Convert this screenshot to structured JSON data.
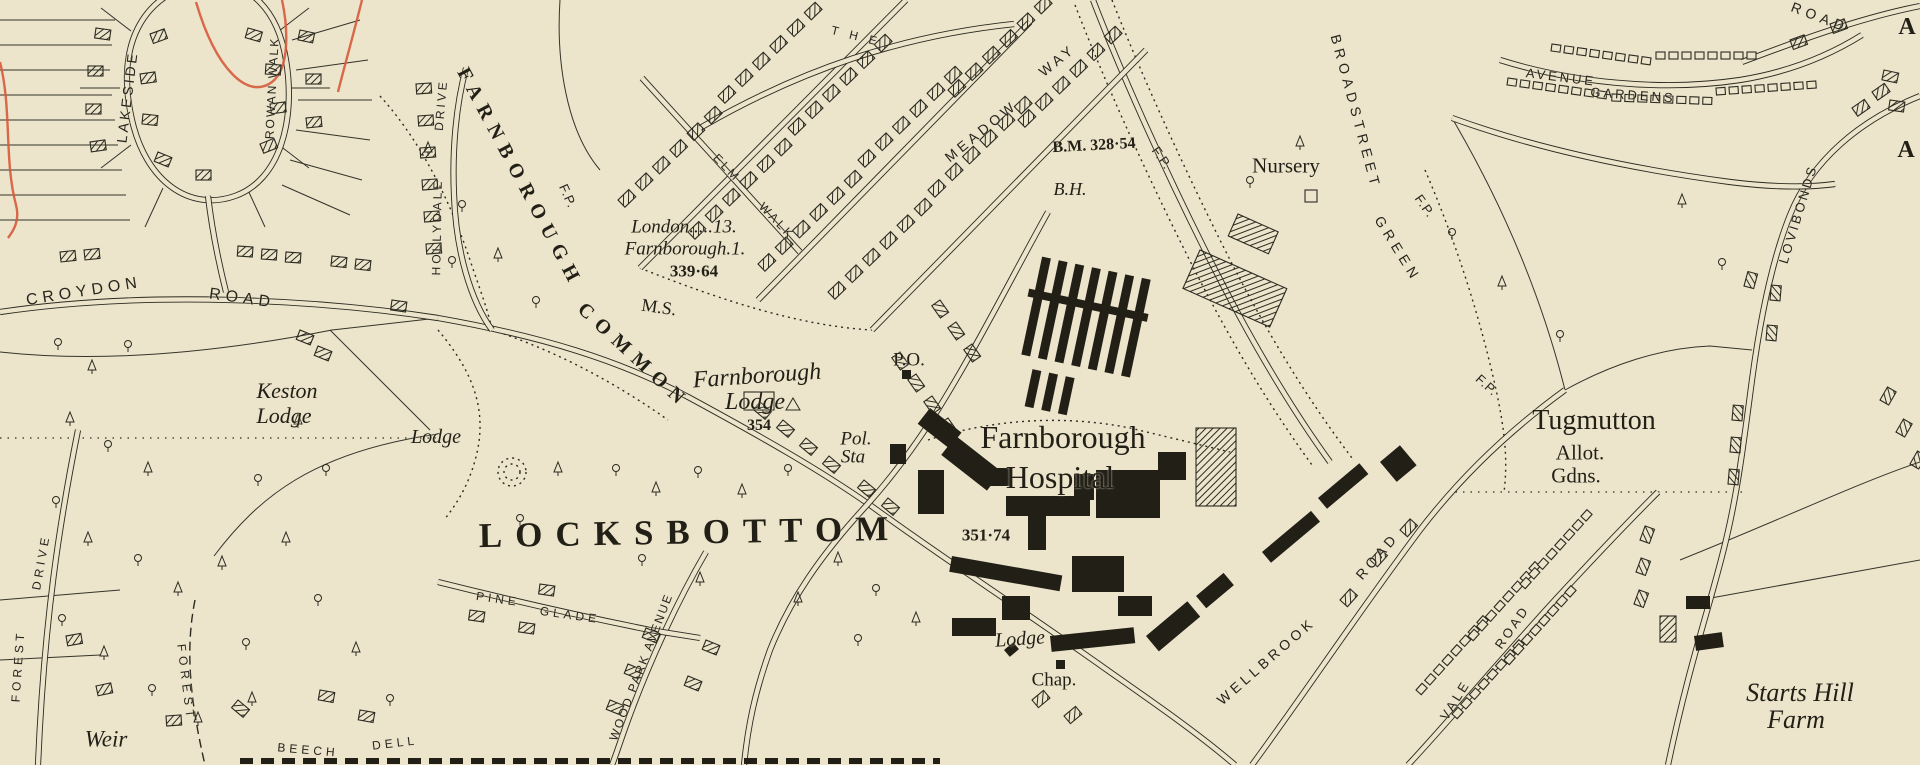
{
  "map": {
    "colors": {
      "paper": "#ece4cb",
      "ink": "#211f16",
      "boundary_red": "#d75a3c"
    },
    "labels": [
      {
        "t": "LAKESIDE",
        "x": 127,
        "y": 97,
        "r": -83,
        "s": 14,
        "ls": 3,
        "c": "street"
      },
      {
        "t": "ROWAN WALK",
        "x": 272,
        "y": 88,
        "r": -87,
        "s": 12,
        "ls": 2,
        "c": "street"
      },
      {
        "t": "CROYDON",
        "x": 84,
        "y": 292,
        "r": -9,
        "s": 16,
        "ls": 5,
        "c": "street"
      },
      {
        "t": "ROAD",
        "x": 242,
        "y": 299,
        "r": 8,
        "s": 16,
        "ls": 5,
        "c": "street"
      },
      {
        "t": "Keston",
        "x": 287,
        "y": 391,
        "r": 0,
        "s": 22,
        "c": "italic"
      },
      {
        "t": "Lodge",
        "x": 284,
        "y": 416,
        "r": 0,
        "s": 22,
        "c": "italic"
      },
      {
        "t": "Lodge",
        "x": 436,
        "y": 437,
        "r": 0,
        "s": 20,
        "c": "italic"
      },
      {
        "t": "DRIVE",
        "x": 441,
        "y": 105,
        "r": -85,
        "s": 12,
        "ls": 3,
        "c": "street"
      },
      {
        "t": "HOLLYDALE",
        "x": 437,
        "y": 227,
        "r": -89,
        "s": 12,
        "ls": 3,
        "c": "street"
      },
      {
        "t": "FARNBOROUGH",
        "x": 520,
        "y": 178,
        "r": 62,
        "s": 20,
        "ls": 8,
        "c": "caps"
      },
      {
        "t": "COMMON",
        "x": 634,
        "y": 356,
        "r": 43,
        "s": 20,
        "ls": 8,
        "c": "caps"
      },
      {
        "t": "F.P.",
        "x": 568,
        "y": 196,
        "r": 66,
        "s": 13,
        "ls": 1,
        "c": "street"
      },
      {
        "t": "London.....13.",
        "x": 684,
        "y": 227,
        "r": 0,
        "s": 19,
        "c": "italic"
      },
      {
        "t": "Farnborough.1.",
        "x": 685,
        "y": 249,
        "r": 0,
        "s": 19,
        "c": "italic"
      },
      {
        "t": "339·64",
        "x": 694,
        "y": 271,
        "r": 0,
        "s": 17,
        "c": "num"
      },
      {
        "t": "M.S.",
        "x": 659,
        "y": 307,
        "r": 8,
        "s": 18,
        "c": "serif"
      },
      {
        "t": "ELM",
        "x": 727,
        "y": 168,
        "r": 46,
        "s": 12,
        "ls": 3,
        "c": "street"
      },
      {
        "t": "WALK",
        "x": 777,
        "y": 221,
        "r": 46,
        "s": 12,
        "ls": 3,
        "c": "street"
      },
      {
        "t": "T H E",
        "x": 856,
        "y": 36,
        "r": 14,
        "s": 12,
        "ls": 4,
        "c": "street"
      },
      {
        "t": "MEADOW",
        "x": 981,
        "y": 131,
        "r": -39,
        "s": 14,
        "ls": 4,
        "c": "street"
      },
      {
        "t": "WAY",
        "x": 1057,
        "y": 60,
        "r": -39,
        "s": 14,
        "ls": 4,
        "c": "street"
      },
      {
        "t": "B.M. 328·54",
        "x": 1094,
        "y": 146,
        "r": -3,
        "s": 16,
        "c": "num"
      },
      {
        "t": "B.H.",
        "x": 1070,
        "y": 189,
        "r": 0,
        "s": 18,
        "c": "italic"
      },
      {
        "t": "Nursery",
        "x": 1286,
        "y": 166,
        "r": 0,
        "s": 21,
        "c": "serif"
      },
      {
        "t": "BROADSTREET",
        "x": 1356,
        "y": 112,
        "r": 75,
        "s": 14,
        "ls": 5,
        "c": "street"
      },
      {
        "t": "GREEN",
        "x": 1398,
        "y": 249,
        "r": 58,
        "s": 14,
        "ls": 5,
        "c": "street"
      },
      {
        "t": "F.P.",
        "x": 1162,
        "y": 158,
        "r": 55,
        "s": 13,
        "ls": 1,
        "c": "street"
      },
      {
        "t": "F.P.",
        "x": 1425,
        "y": 206,
        "r": 55,
        "s": 13,
        "ls": 1,
        "c": "street"
      },
      {
        "t": "AVENUE",
        "x": 1561,
        "y": 77,
        "r": 7,
        "s": 13,
        "ls": 3,
        "c": "street"
      },
      {
        "t": "GARDENS",
        "x": 1633,
        "y": 95,
        "r": 4,
        "s": 13,
        "ls": 3,
        "c": "street"
      },
      {
        "t": "ROAD",
        "x": 1820,
        "y": 17,
        "r": 21,
        "s": 14,
        "ls": 5,
        "c": "street"
      },
      {
        "t": "LOVIBONDS",
        "x": 1798,
        "y": 214,
        "r": -73,
        "s": 13,
        "ls": 3,
        "c": "street"
      },
      {
        "t": "A",
        "x": 1907,
        "y": 27,
        "r": 0,
        "s": 24,
        "c": "caps"
      },
      {
        "t": "A",
        "x": 1906,
        "y": 150,
        "r": 0,
        "s": 24,
        "c": "caps"
      },
      {
        "t": "Tugmutton",
        "x": 1594,
        "y": 421,
        "r": 0,
        "s": 28,
        "c": "serif"
      },
      {
        "t": "Allot.",
        "x": 1580,
        "y": 453,
        "r": 0,
        "s": 21,
        "c": "serif"
      },
      {
        "t": "Gdns.",
        "x": 1576,
        "y": 476,
        "r": 0,
        "s": 21,
        "c": "serif"
      },
      {
        "t": "F.P.",
        "x": 1487,
        "y": 385,
        "r": 42,
        "s": 13,
        "ls": 1,
        "c": "street"
      },
      {
        "t": "Starts Hill",
        "x": 1800,
        "y": 693,
        "r": 0,
        "s": 26,
        "c": "italic"
      },
      {
        "t": "Farm",
        "x": 1796,
        "y": 720,
        "r": 0,
        "s": 26,
        "c": "italic"
      },
      {
        "t": "Weir",
        "x": 106,
        "y": 739,
        "r": 0,
        "s": 23,
        "c": "italic"
      },
      {
        "t": "DRIVE",
        "x": 41,
        "y": 562,
        "r": -80,
        "s": 12,
        "ls": 4,
        "c": "street"
      },
      {
        "t": "FOREST",
        "x": 18,
        "y": 666,
        "r": -86,
        "s": 12,
        "ls": 4,
        "c": "street"
      },
      {
        "t": "FOREST",
        "x": 186,
        "y": 683,
        "r": 83,
        "s": 12,
        "ls": 5,
        "c": "street"
      },
      {
        "t": "BEECH",
        "x": 308,
        "y": 750,
        "r": 5,
        "s": 12,
        "ls": 4,
        "c": "street"
      },
      {
        "t": "DELL",
        "x": 395,
        "y": 743,
        "r": -7,
        "s": 12,
        "ls": 4,
        "c": "street"
      },
      {
        "t": "PINE",
        "x": 498,
        "y": 599,
        "r": 8,
        "s": 12,
        "ls": 4,
        "c": "street"
      },
      {
        "t": "GLADE",
        "x": 570,
        "y": 615,
        "r": 8,
        "s": 12,
        "ls": 4,
        "c": "street"
      },
      {
        "t": "WOOD PARK AVENUE",
        "x": 641,
        "y": 667,
        "r": -69,
        "s": 12,
        "ls": 2,
        "c": "street"
      },
      {
        "t": "LOCKSBOTTOM",
        "x": 690,
        "y": 532,
        "r": -1,
        "s": 35,
        "ls": 13,
        "c": "caps"
      },
      {
        "t": "Farnborough",
        "x": 757,
        "y": 376,
        "r": -4,
        "s": 24,
        "c": "italic"
      },
      {
        "t": "Lodge",
        "x": 755,
        "y": 402,
        "r": 0,
        "s": 24,
        "c": "italic"
      },
      {
        "t": "354",
        "x": 759,
        "y": 426,
        "r": 0,
        "s": 16,
        "c": "num"
      },
      {
        "t": "Pol.",
        "x": 856,
        "y": 439,
        "r": 0,
        "s": 19,
        "c": "italic"
      },
      {
        "t": "Sta",
        "x": 853,
        "y": 457,
        "r": 0,
        "s": 19,
        "c": "italic"
      },
      {
        "t": "P.O.",
        "x": 909,
        "y": 360,
        "r": 0,
        "s": 19,
        "c": "serif"
      },
      {
        "t": "Farnborough",
        "x": 1063,
        "y": 437,
        "r": 0,
        "s": 32,
        "c": "serif"
      },
      {
        "t": "Hospital",
        "x": 1060,
        "y": 477,
        "r": 0,
        "s": 32,
        "c": "serif"
      },
      {
        "t": "351·74",
        "x": 986,
        "y": 535,
        "r": 0,
        "s": 17,
        "c": "num"
      },
      {
        "t": "Lodge",
        "x": 1020,
        "y": 639,
        "r": -4,
        "s": 20,
        "c": "italic"
      },
      {
        "t": "Chap.",
        "x": 1054,
        "y": 680,
        "r": 0,
        "s": 19,
        "c": "serif"
      },
      {
        "t": "WELLBROOK",
        "x": 1266,
        "y": 661,
        "r": -41,
        "s": 14,
        "ls": 4,
        "c": "street"
      },
      {
        "t": "ROAD",
        "x": 1377,
        "y": 556,
        "r": -49,
        "s": 14,
        "ls": 4,
        "c": "street"
      },
      {
        "t": "VALE",
        "x": 1455,
        "y": 700,
        "r": -58,
        "s": 13,
        "ls": 3,
        "c": "street"
      },
      {
        "t": "ROAD",
        "x": 1512,
        "y": 627,
        "r": -55,
        "s": 13,
        "ls": 3,
        "c": "street"
      }
    ]
  }
}
